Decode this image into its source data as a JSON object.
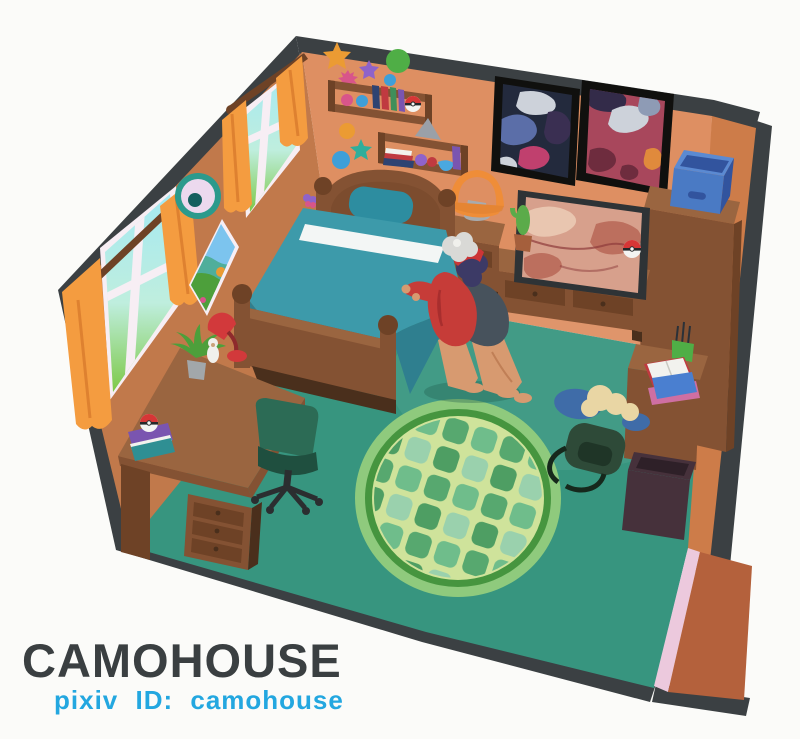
{
  "artwork": {
    "artist_name": "CAMOHOUSE",
    "credit_line": "pixiv ID: camohouse"
  },
  "palette": {
    "bg": "#fbfbf9",
    "trim": "#3b4043",
    "wall-left": "#c1794b",
    "wall-back": "#de8f62",
    "wall-right": "#cd7c49",
    "floor": "#37957f",
    "mat": "#b4613c",
    "pink-strip": "#ecc9dd",
    "rug-edge": "#8fca7d",
    "rug-ring": "#46953f",
    "rug-field": "#cfe39b",
    "tile-a": "#57a86f",
    "tile-b": "#6fbd8b",
    "tile-c": "#4e9e63",
    "tile-d": "#9ad1ad",
    "wood-dark": "#6e4226",
    "wood-mid": "#845233",
    "wood-light": "#9a6540",
    "wood-xlight": "#aa7450",
    "wood-shadow": "#4a2f1c",
    "blanket": "#3d9aaa",
    "blanket-shadow": "#2f7f8f",
    "stripe-white": "#f3f6f5",
    "pillow": "#2d8da0",
    "curtain": "#f49c40",
    "curtain-dark": "#de8130",
    "window-frame": "#f7eef4",
    "window-sky": "#a5e9f2",
    "window-grass": "#7dc947",
    "deco-ring": "#2b9a8c",
    "deco-face": "#ecd9ee",
    "deco-pupil": "#155f5e",
    "poster-frame": "#10100e",
    "poster1-base": "#232a3d",
    "poster2-base": "#a8475c",
    "blob-steel": "#5b6ea8",
    "blob-gray": "#cdd2da",
    "blob-magenta": "#c0406e",
    "blob-plum": "#6e2c3e",
    "blob-dark-purple": "#3a2f52",
    "blob-orange": "#e08a3c",
    "blob-bluegray": "#8e9bb5",
    "blob-navy": "#332b49",
    "tv-frame": "#2e3336",
    "screen-base": "#d7a08c",
    "screen-warm-light": "#e9c6b0",
    "screen-warm-dark": "#bc6f5e",
    "screen-line": "#8e3b3b",
    "lamp-shade": "#ef8d38",
    "lamp-base": "#a8abae",
    "bin-blue": "#4a7ac4",
    "bin-blue-dark": "#32549e",
    "bin-blue-light": "#5b8ad2",
    "chair-green": "#2c6b55",
    "chair-dark": "#1f4f3f",
    "chair-base": "#2b2e30",
    "desk-lamp-red": "#d2393b",
    "plant-green": "#4d9f3b",
    "pot-gray": "#a2a7aa",
    "pot-terra": "#a55f3c",
    "cactus-green": "#5bab4a",
    "book-navy": "#2e4372",
    "book-red": "#c03a40",
    "book-green": "#3f8f5a",
    "book-purple": "#7a55b0",
    "book-teal": "#2f8f93",
    "book-white": "#f2f2ee",
    "book-blue": "#4a7fd0",
    "book-pink": "#cf6fa2",
    "pokeball-red": "#d63636",
    "pokeball-white": "#f4f4f2",
    "pokeball-dark": "#25282a",
    "backpack-green": "#2e4a38",
    "backpack-dark": "#16281c",
    "clothes-blue": "#3f6ca8",
    "clothes-cream": "#e9d6a4",
    "skin": "#d79a70",
    "skin-shadow": "#c07f56",
    "hair-navy": "#3c3a66",
    "hair-gray": "#d9d9d6",
    "cap-red": "#cc3536",
    "jacket-red": "#c63c38",
    "jacket-red-dark": "#a82e2e",
    "shirt-slate": "#47525c",
    "star-orange": "#eb9b33",
    "star-purple": "#8f63c9",
    "star-teal": "#2fae9b",
    "circle-green": "#4fae46",
    "circle-blue": "#3f9fd8",
    "yarn-pink": "#d8558a",
    "yarn-purple": "#8f63c9",
    "yarn-red": "#c03a40",
    "bowl-blue": "#4aa8e0",
    "pyramid-gray": "#9aa0a8",
    "trash": "#46313b",
    "trash-dark": "#2e2028",
    "white-soft": "#f0f0ec",
    "text-dark": "#3a3f41",
    "text-cyan": "#23a7e0"
  }
}
